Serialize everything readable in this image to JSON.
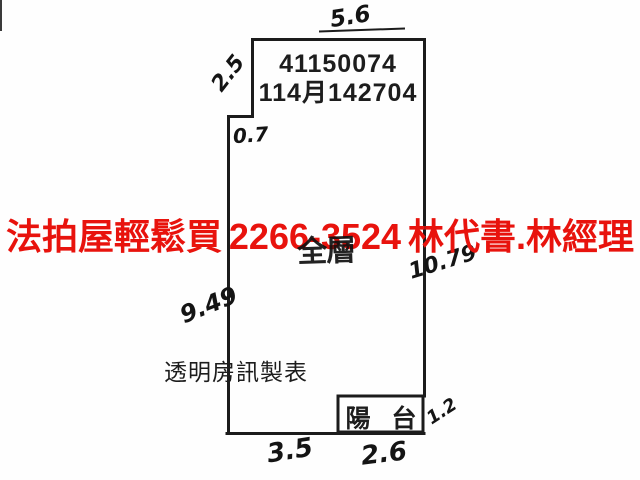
{
  "floor_plan": {
    "case_numbers": {
      "line1": "41150074",
      "line2": "114月142704"
    },
    "room_label_handwritten": "全層",
    "maker_credit": "透明房訊製表",
    "balcony_label": "陽 台",
    "dimensions": {
      "top": "5.6",
      "upper_left": "2.5",
      "left_step": "0.7",
      "right": "10.79",
      "left": "9.49",
      "balcony_right": "1.2",
      "bottom_main": "3.5",
      "bottom_balcony": "2.6"
    },
    "wall_color": "#1c1c1c"
  },
  "overlay_ad": {
    "agency": "法拍屋輕鬆買",
    "phone": "2266-3524",
    "contacts": "林代書.林經理",
    "color": "#e8130d"
  }
}
